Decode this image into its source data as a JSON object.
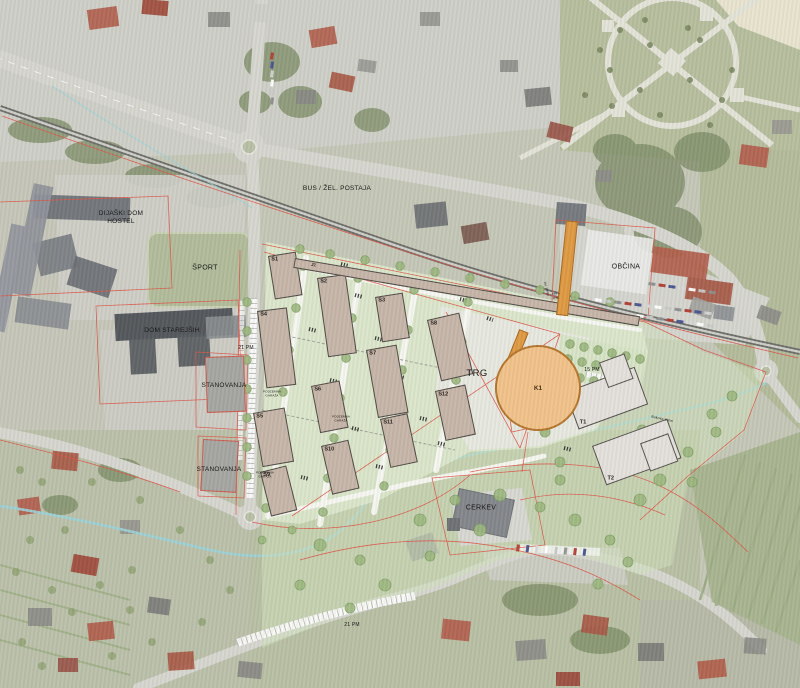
{
  "meta": {
    "type": "masterplan-aerial-map"
  },
  "colors": {
    "site_green": "#dce8cc",
    "park_green": "#cfe0bb",
    "building_fill": "#c7b6a9",
    "building_outline": "#504b46",
    "tower_fill": "#e4e0dc",
    "landmark_fill": "#f2c38b",
    "landmark_outline": "#b5762e",
    "accent_orange": "#df9a44",
    "parcel_red": "#dc5648",
    "stream_blue": "#9ed3d8",
    "road_gray": "#d7d7d1"
  },
  "labels": [
    {
      "id": "bus-zel-postaja",
      "text": "BUS / ŽEL. POSTAJA",
      "x": 337,
      "y": 189,
      "size": 6.5,
      "rot": 0
    },
    {
      "id": "obcina",
      "text": "OBČINA",
      "x": 626,
      "y": 268,
      "size": 7,
      "rot": 0
    },
    {
      "id": "dijaski-dom-hostel",
      "text": "DIJAŠKI DOM\nHOSTEL",
      "x": 121,
      "y": 218,
      "size": 6.5,
      "rot": 0
    },
    {
      "id": "sport",
      "text": "ŠPORT",
      "x": 205,
      "y": 269,
      "size": 7,
      "rot": 0
    },
    {
      "id": "dom-starejsih",
      "text": "DOM STAREJŠIH",
      "x": 172,
      "y": 331,
      "size": 6.5,
      "rot": 0
    },
    {
      "id": "stanovanja-1",
      "text": "STANOVANJA",
      "x": 224,
      "y": 386,
      "size": 6.5,
      "rot": 0
    },
    {
      "id": "stanovanja-2",
      "text": "STANOVANJA",
      "x": 219,
      "y": 470,
      "size": 6.5,
      "rot": 0
    },
    {
      "id": "trg",
      "text": "TRG",
      "x": 477,
      "y": 374,
      "size": 9.5,
      "rot": 0
    },
    {
      "id": "cerkev",
      "text": "CERKEV",
      "x": 481,
      "y": 509,
      "size": 7,
      "rot": 0
    },
    {
      "id": "pm21-west",
      "text": "21 PM",
      "x": 246,
      "y": 348,
      "size": 5,
      "rot": 0
    },
    {
      "id": "pm21-south",
      "text": "21 PM",
      "x": 352,
      "y": 625,
      "size": 5,
      "rot": 0
    },
    {
      "id": "pm15",
      "text": "15 PM",
      "x": 592,
      "y": 370,
      "size": 5,
      "rot": 0
    },
    {
      "id": "podzemna-garaza-1",
      "text": "PODZEMNA\nGARAŽA",
      "x": 272,
      "y": 394,
      "size": 3,
      "rot": 0
    },
    {
      "id": "podzemna-garaza-2",
      "text": "PODZEMNA\nGARAŽA",
      "x": 341,
      "y": 419,
      "size": 3,
      "rot": 0
    },
    {
      "id": "podzemna-garaza-3",
      "text": "PODZEMNA\nGARAŽA",
      "x": 265,
      "y": 475,
      "size": 3,
      "rot": 0
    },
    {
      "id": "pes-graj",
      "text": "peš +\ngraj.",
      "x": 556,
      "y": 296,
      "size": 3,
      "rot": 0
    },
    {
      "id": "zel-proga",
      "text": "žel. proga",
      "x": 546,
      "y": 289,
      "size": 3,
      "rot": 75
    },
    {
      "id": "bukova-zona",
      "text": "Bukova zona",
      "x": 662,
      "y": 419,
      "size": 3.5,
      "rot": 12
    }
  ],
  "plan_buildings": [
    {
      "id": "s1",
      "label": "S1",
      "x": 268,
      "y": 256,
      "w": 28,
      "h": 44,
      "rot": -9
    },
    {
      "id": "s2",
      "label": "S2",
      "x": 317,
      "y": 278,
      "w": 29,
      "h": 80,
      "rot": -8
    },
    {
      "id": "s3",
      "label": "S3",
      "x": 375,
      "y": 297,
      "w": 28,
      "h": 46,
      "rot": -9
    },
    {
      "id": "s4",
      "label": "S4",
      "x": 257,
      "y": 311,
      "w": 30,
      "h": 78,
      "rot": -7
    },
    {
      "id": "s5",
      "label": "S5",
      "x": 253,
      "y": 413,
      "w": 32,
      "h": 55,
      "rot": -10
    },
    {
      "id": "s6",
      "label": "S6",
      "x": 311,
      "y": 386,
      "w": 29,
      "h": 48,
      "rot": -11
    },
    {
      "id": "s7",
      "label": "S7",
      "x": 366,
      "y": 350,
      "w": 31,
      "h": 69,
      "rot": -10
    },
    {
      "id": "s8",
      "label": "S8",
      "x": 427,
      "y": 320,
      "w": 33,
      "h": 63,
      "rot": -13
    },
    {
      "id": "s9",
      "label": "S9",
      "x": 260,
      "y": 472,
      "w": 27,
      "h": 46,
      "rot": -14
    },
    {
      "id": "s10",
      "label": "S10",
      "x": 321,
      "y": 446,
      "w": 28,
      "h": 50,
      "rot": -13
    },
    {
      "id": "s11",
      "label": "S11",
      "x": 380,
      "y": 419,
      "w": 28,
      "h": 50,
      "rot": -12
    },
    {
      "id": "s12",
      "label": "S12",
      "x": 435,
      "y": 391,
      "w": 31,
      "h": 51,
      "rot": -12
    },
    {
      "id": "j1",
      "label": "J1",
      "x": 295,
      "y": 258,
      "w": 350,
      "h": 10,
      "rot": 9.6,
      "strip": true
    }
  ],
  "tower_buildings": [
    {
      "id": "t1",
      "label": "T1",
      "x": 565,
      "y": 392,
      "w": 74,
      "h": 40,
      "rot": -20,
      "annex": {
        "dx": 42,
        "dy": -16,
        "w": 27,
        "h": 27
      }
    },
    {
      "id": "t2",
      "label": "T2",
      "x": 592,
      "y": 446,
      "w": 80,
      "h": 42,
      "rot": -20,
      "annex": {
        "dx": 46,
        "dy": 14,
        "w": 30,
        "h": 30
      }
    }
  ],
  "landmark": {
    "id": "k1",
    "label": "K1",
    "cx": 538,
    "cy": 388,
    "r": 43
  }
}
